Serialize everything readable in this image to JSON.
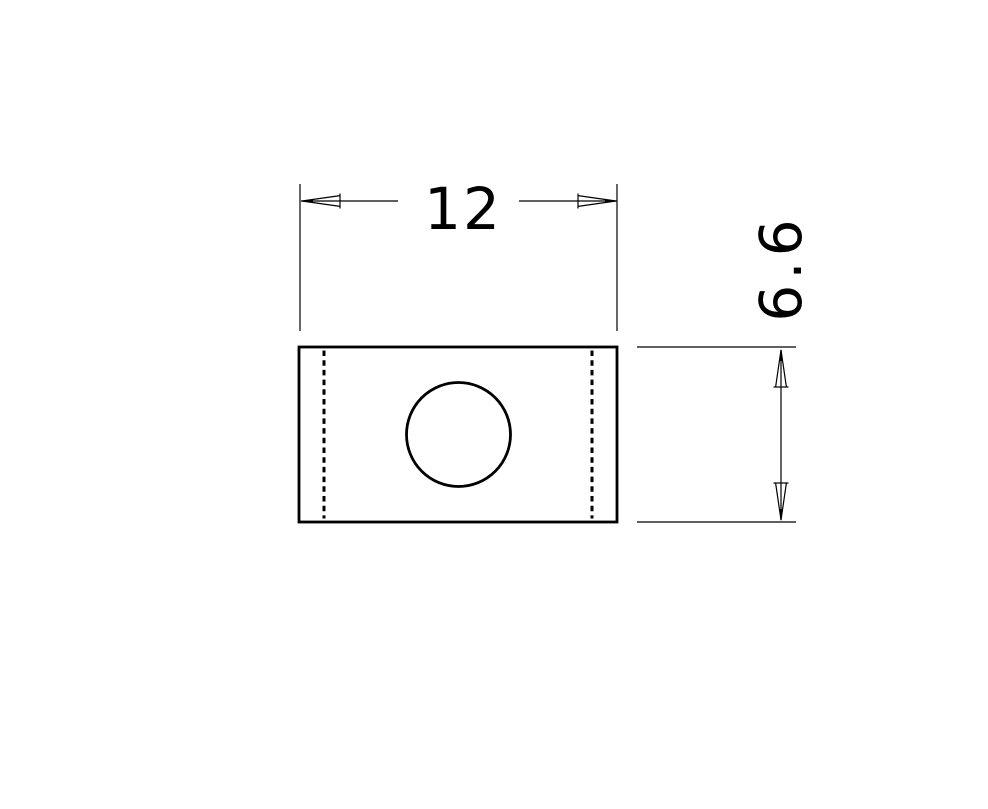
{
  "drawing": {
    "stroke_color": "#000000",
    "background_color": "#ffffff",
    "dimensions": {
      "width": {
        "value": "12",
        "orientation": "horizontal"
      },
      "height": {
        "value": "6.6",
        "orientation": "vertical"
      }
    }
  }
}
